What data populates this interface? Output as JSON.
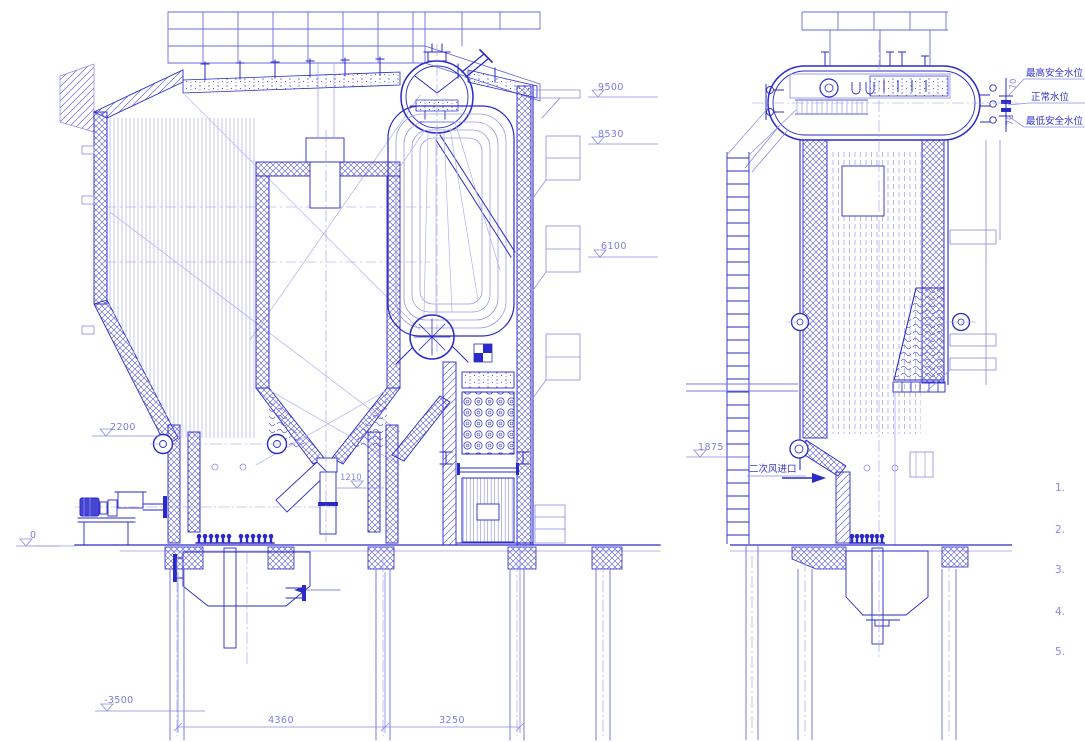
{
  "drawing_kind": "industrial boiler general arrangement, two sectional views, CAD blueprint style",
  "colors": {
    "line_primary": "#2a2ac8",
    "line_light": "#9a9ae6",
    "hatch": "#5050d4",
    "dim_text": "#7d7de0",
    "label_text": "#3434cc",
    "background": "#ffffff"
  },
  "left": {
    "view_name": "front sectional elevation",
    "elev_9500": "9500",
    "elev_8530": "8530",
    "elev_6100": "6100",
    "elev_2200": "2200",
    "elev_0": "0",
    "elev_neg3500": "-3500",
    "dim_1210": "1210",
    "dim_4360": "4360",
    "dim_3250": "3250"
  },
  "right": {
    "view_name": "side sectional elevation",
    "elev_1875": "1875",
    "water_high": "最高安全水位",
    "water_normal": "正常水位",
    "water_low": "最低安全水位",
    "off_70_up": "70",
    "off_70_dn": "70",
    "air_inlet": "二次风进口",
    "note_1": "1.",
    "note_2": "2.",
    "note_3": "3.",
    "note_4": "4.",
    "note_5": "5."
  }
}
